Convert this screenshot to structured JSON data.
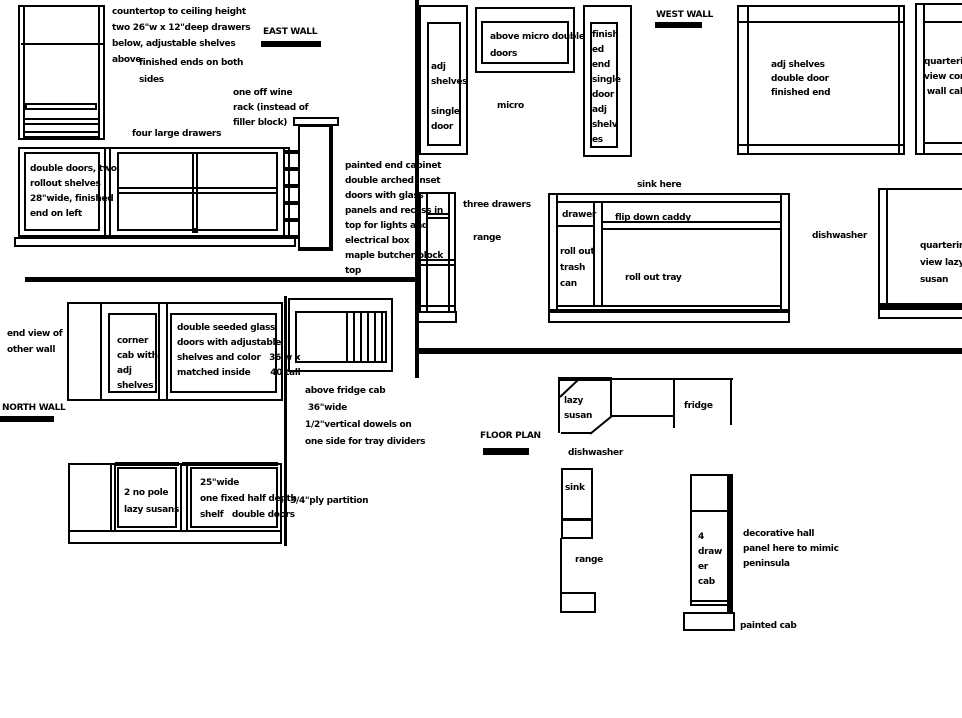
{
  "colors": {
    "line": "#000000",
    "background": "#ffffff"
  },
  "east_wall": {
    "heading": "EAST WALL",
    "tall_cab_note": "countertop to ceiling height\ntwo 26\"w x 12\"deep drawers\nbelow, adjustable shelves\nabove",
    "finished_ends_note": "finished ends on both\nsides",
    "wine_rack_note": "one off wine\nrack (instead of\nfiller block)",
    "four_drawers_note": "four large drawers",
    "base_left_note": "double doors, two\nrollout shelves\n28\"wide, finished\nend on left",
    "painted_end_note": "painted end cabinet\ndouble arched inset\ndoors with glass\npanels and recess in\ntop for lights and\nelectrical box\nmaple butcher block\ntop"
  },
  "west_wall": {
    "heading": "WEST WALL",
    "single_door_note": "adj\nshelves\n\nsingle\ndoor",
    "above_micro_note": "above micro double\ndoors",
    "micro_label": "micro",
    "finished_end_note": "finish\ned\nend\nsingle\ndoor\nadj\nshelv\nes",
    "double_door_note": "adj shelves\ndouble door\nfinished end",
    "corner_wall_note": "quartering\nview corner\n wall cab",
    "three_drawers_label": "three drawers",
    "range_label": "range",
    "sink_here_label": "sink here",
    "drawer_label": "drawer",
    "flip_down_caddy_label": "flip down caddy",
    "roll_out_trash_note": "roll out\ntrash\ncan",
    "roll_out_tray_label": "roll out tray",
    "dishwasher_label": "dishwasher",
    "lazy_susan_note": "quartering\nview lazy\nsusan"
  },
  "north_wall": {
    "heading": "NORTH WALL",
    "end_view_note": "end view of\nother wall",
    "corner_cab_note": "corner\ncab with\nadj\nshelves",
    "glass_doors_note": "double seeded glass\ndoors with adjustable\nshelves and color   36 w x\nmatched inside       40 tall",
    "above_fridge_note": "above fridge cab\n 36\"wide\n1/2\"vertical dowels on\none side for tray dividers",
    "lazy_susans_note": "2 no pole\nlazy susans",
    "double_doors_note": "25\"wide\none fixed half depth\nshelf   double doors",
    "ply_partition_label": "3/4\"ply partition"
  },
  "floor_plan": {
    "heading": "FLOOR PLAN",
    "lazy_susan_label": "lazy\nsusan",
    "fridge_label": "fridge",
    "dishwasher_label": "dishwasher",
    "sink_label": "sink",
    "range_label": "range",
    "four_drawer_label": "4\ndraw\ner\ncab",
    "decorative_panel_note": "decorative hall\npanel here to mimic\npeninsula",
    "painted_cab_label": "painted cab"
  }
}
